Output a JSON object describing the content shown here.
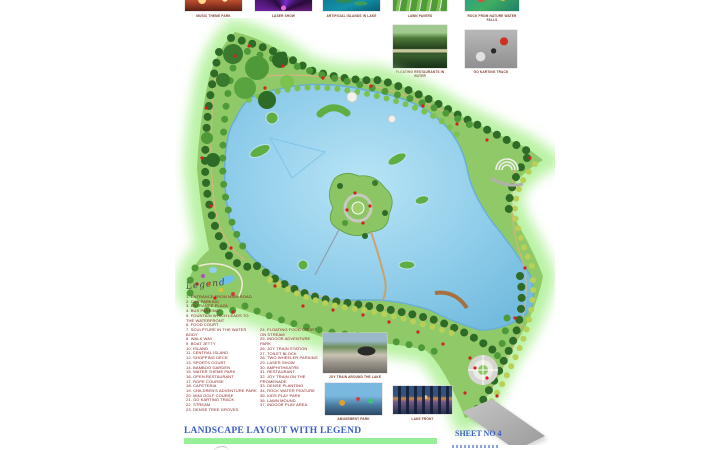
{
  "header_thumbnails": [
    {
      "caption": "MUSIC THEME PARK"
    },
    {
      "caption": "LASER SHOW"
    },
    {
      "caption": "ARTIFICIAL ISLANDS IN LAKE"
    },
    {
      "caption": "LAWN PAVERS"
    },
    {
      "caption": "ROCK FROM NATURE WATER FALLS"
    }
  ],
  "side_photos": [
    {
      "caption": "FLOATING RESTAURANTS IN WATER"
    },
    {
      "caption": "GO KARTING TRACK"
    }
  ],
  "inset_photos": [
    {
      "caption": "JOY TRAIN AROUND THE LAKE"
    },
    {
      "caption": "AMUSEMENT PARK"
    },
    {
      "caption": "LAKE FRONT"
    }
  ],
  "legend": {
    "title": "Legend",
    "column1": [
      "1. ENTRANCE FROM MAIN ROAD",
      "2. CAR PARKING",
      "3. ENTRANCE PLAZA",
      "4. BUS PARKING",
      "5. FOUNTAIN WHICH LEADS TO THE WATERFRONT",
      "6. FOOD COURT",
      "7. SCULPTURE IN THE WATER BODY",
      "8. WALK WAY",
      "9. BOAT JETTY",
      "10. ISLAND",
      "11. CENTRAL ISLAND",
      "12. SHOPPING DECK",
      "13. SPORTS COURT",
      "14. BAMBOO GARDEN",
      "15. WATER THEME PARK",
      "16. OPEN RESTAURANT",
      "17. ROPE COURSE",
      "18. CAFETERIA",
      "19. CHILDREN'S ADVENTURE PARK",
      "20. MINI GOLF COURSE",
      "21. GO KARTING TRACK",
      "22. STREAM",
      "23. DENSE TREE GROVES"
    ],
    "column2": [
      "24. FLOATING FOOD COURT ON STREAM",
      "25. INDOOR ADVENTURE PARK",
      "26. JOY TRAIN STATION",
      "27. TOILET BLOCK",
      "28. TWO WHEELER PARKING",
      "29. LASER SHOW",
      "30. AMPHITHEATRE",
      "31. RESTAURANT",
      "32. JOY TRAIN ON THE PROMENADE",
      "33. DENSE PLANTING",
      "34. ROCK WATER FEATURE",
      "35. KIDS PLAY PARK",
      "36. LAWN MOUND",
      "37. INDOOR PLAY AREA"
    ]
  },
  "footer": {
    "title": "LANDSCAPE LAYOUT WITH LEGEND",
    "sheet": "SHEET NO 4"
  },
  "colors": {
    "title_blue": "#3c5ec6",
    "bar_green": "#97f097",
    "legend_text": "#8b2020",
    "lake_blue": "#7fc4e4",
    "glow_green": "#b2f19b"
  }
}
